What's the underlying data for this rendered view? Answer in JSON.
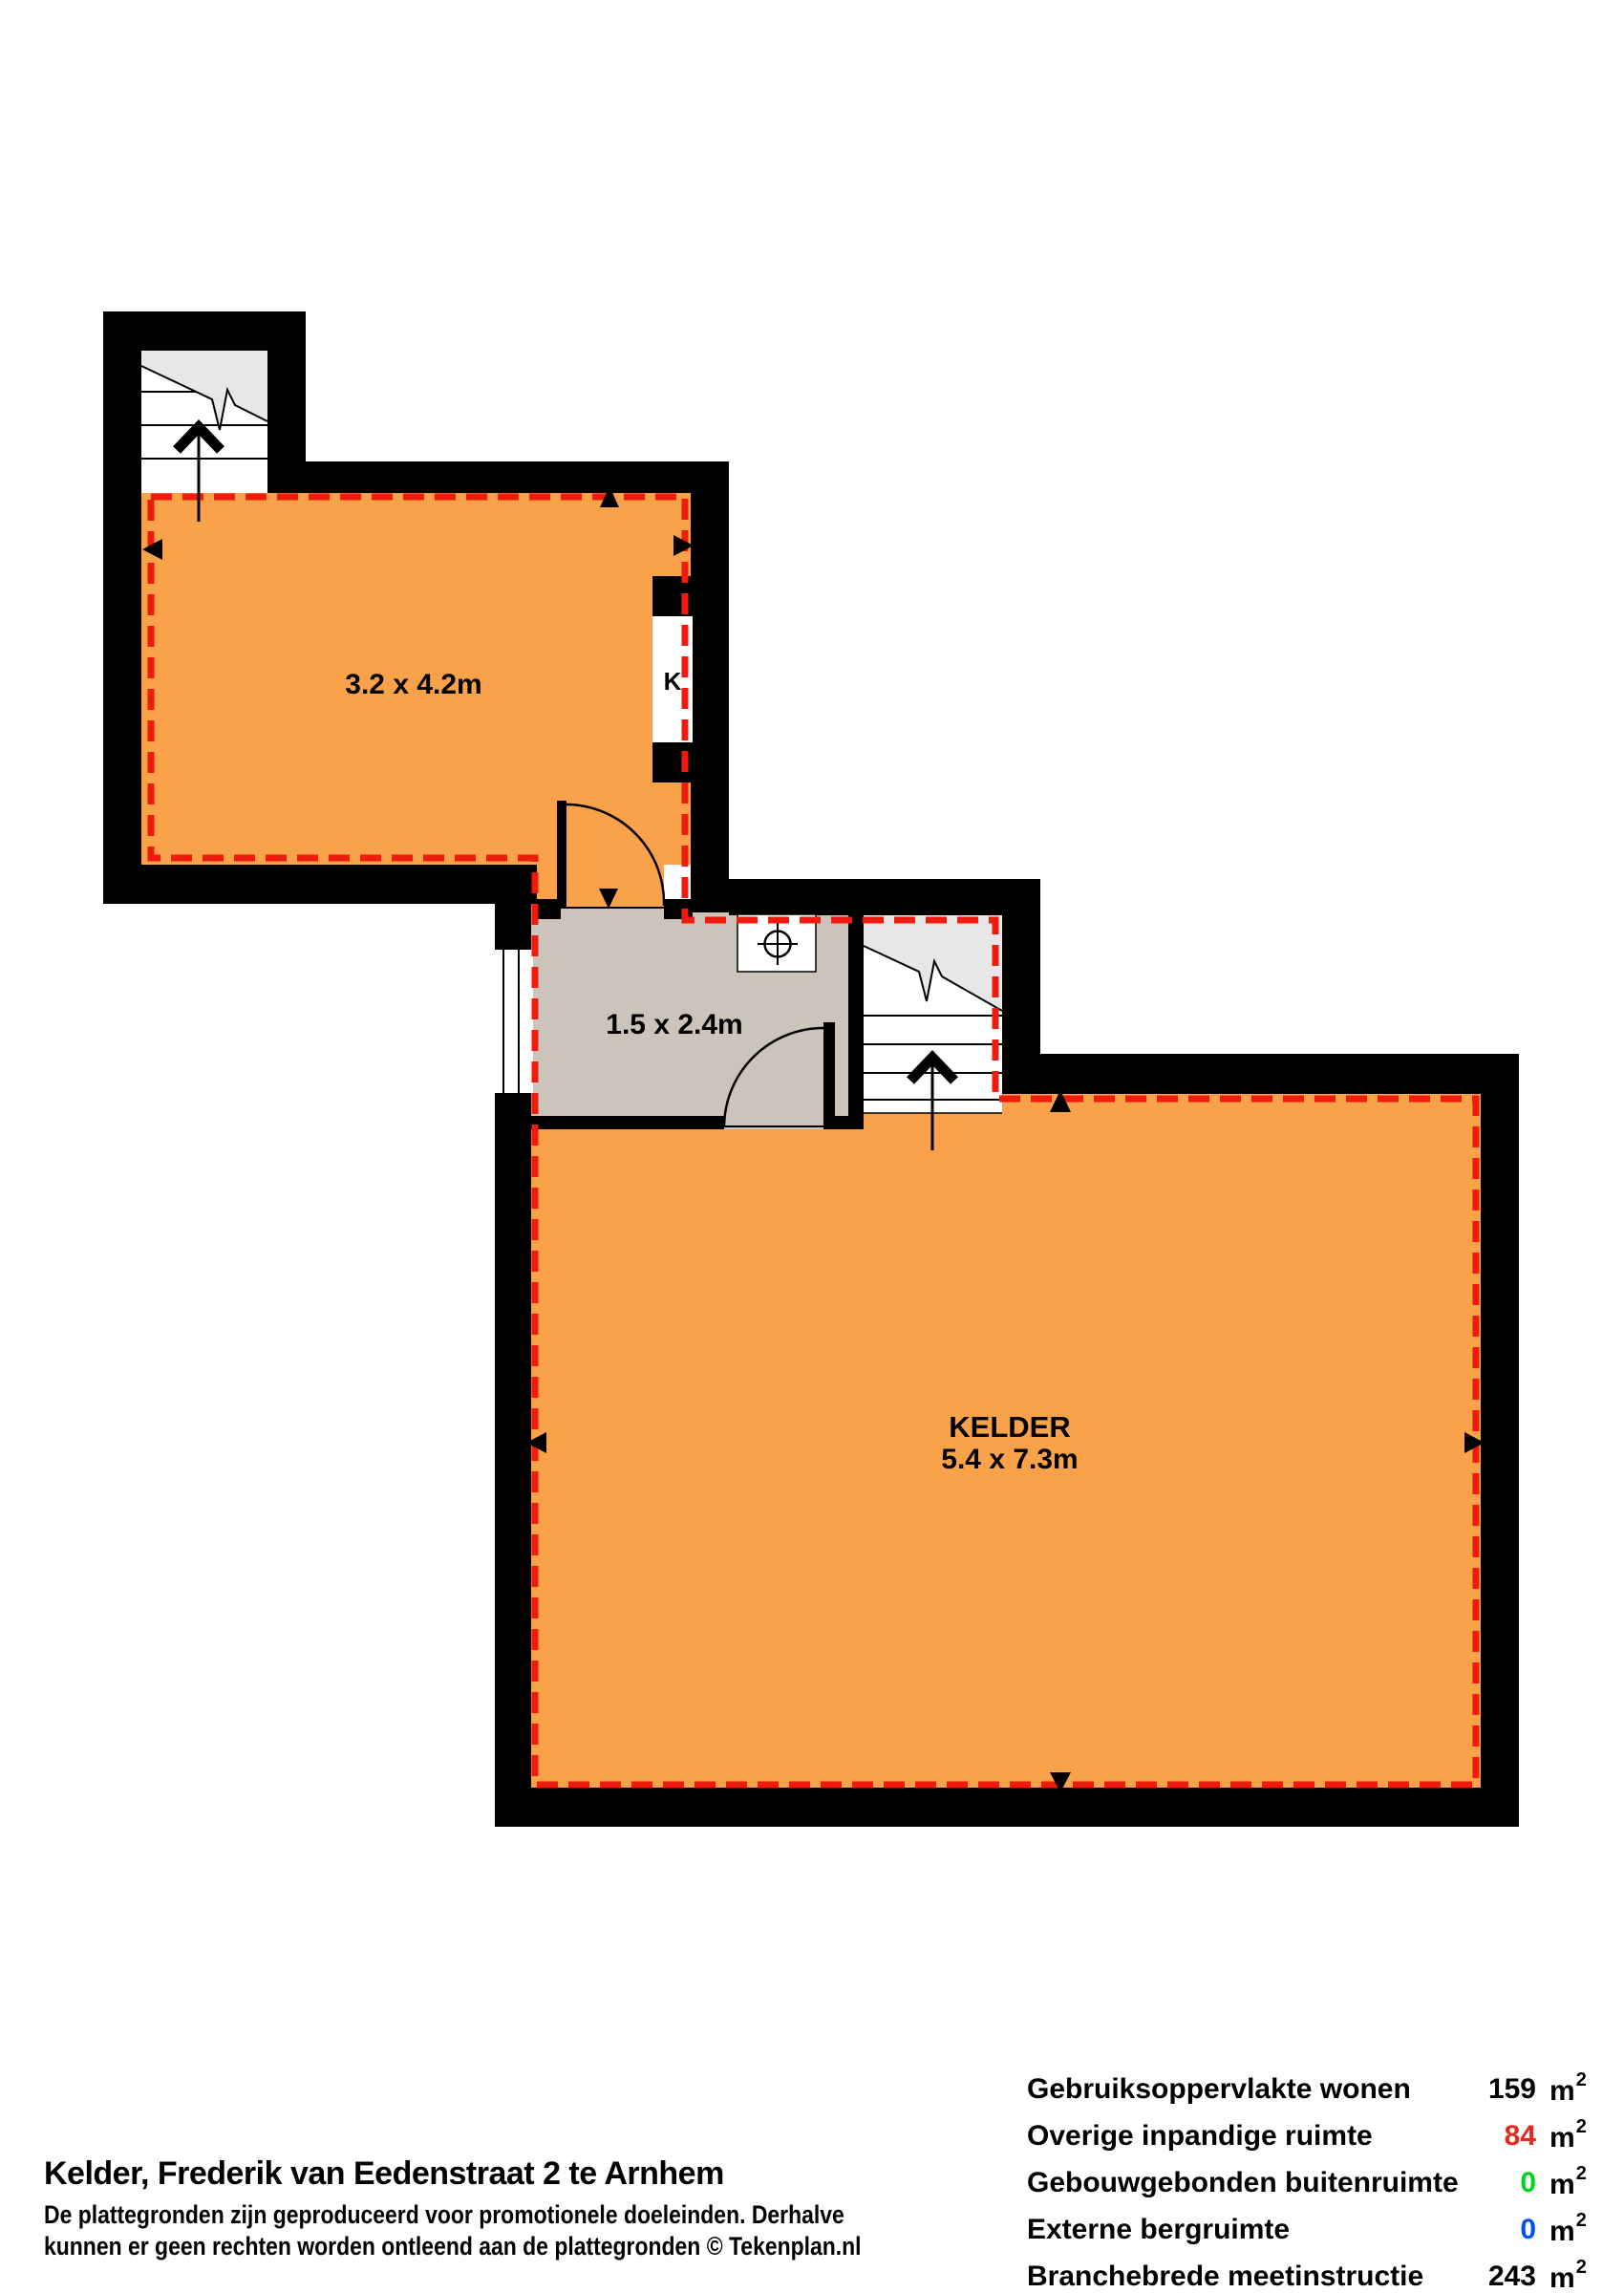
{
  "plan": {
    "rooms": [
      {
        "name": "",
        "dims": "3.2 x 4.2m"
      },
      {
        "name": "",
        "dims": "1.5 x 2.4m"
      },
      {
        "name": "KELDER",
        "dims": "5.4 x 7.3m"
      }
    ],
    "closet_label": "K"
  },
  "legend": {
    "rows": [
      {
        "label": "Gebruiksoppervlakte wonen",
        "value": "159",
        "color": "#000000"
      },
      {
        "label": "Overige inpandige ruimte",
        "value": "84",
        "color": "#e8291c"
      },
      {
        "label": "Gebouwgebonden buitenruimte",
        "value": "0",
        "color": "#00d41e"
      },
      {
        "label": "Externe bergruimte",
        "value": "0",
        "color": "#0051e8"
      },
      {
        "label": "Branchebrede meetinstructie",
        "value": "243",
        "color": "#000000"
      }
    ],
    "unit": "m",
    "unit_sup": "2"
  },
  "footer": {
    "title": "Kelder, Frederik van Eedenstraat 2 te Arnhem",
    "disclaimer1": "De plattegronden zijn geproduceerd voor promotionele doeleinden. Derhalve",
    "disclaimer2": "kunnen er geen rechten worden ontleend aan de plattegronden © Tekenplan.nl"
  },
  "colors": {
    "floor_orange": "#f9a24a",
    "floor_taupe": "#ccc4ba",
    "stairs_gray": "#e7e7e7",
    "wall_black": "#000000",
    "boundary_red": "#ee1b0e"
  }
}
